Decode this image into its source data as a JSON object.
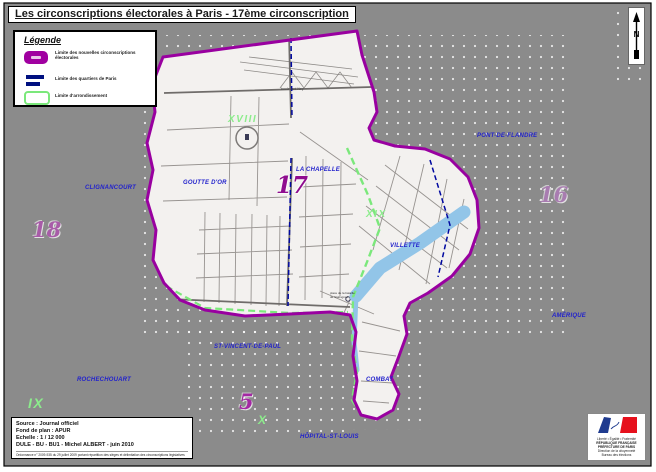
{
  "title": "Les circonscriptions électorales à Paris - 17ème circonscription",
  "legend": {
    "title": "Légende",
    "items": [
      {
        "label": "Limite des nouvelles circonscriptions électorales"
      },
      {
        "label": "Limite des quartiers de Paris"
      },
      {
        "label": "Limite d'arrondissement"
      }
    ]
  },
  "compass": {
    "label": "N"
  },
  "map": {
    "numbers": {
      "n17": "17",
      "n18": "18",
      "n16": "16",
      "n5": "5"
    },
    "arrondissements": {
      "xviii": "XVIII",
      "xix": "XIX",
      "ix": "IX",
      "x": "X"
    },
    "quartiers": {
      "clignancourt": "CLIGNANCOURT",
      "goutte_dor": "GOUTTE D'OR",
      "la_chapelle": "LA CHAPELLE",
      "pont_de_flandre": "PONT-DE-FLANDRE",
      "villette": "VILLETTE",
      "amerique": "AMÉRIQUE",
      "rochechouart": "ROCHECHOUART",
      "st_vincent_de_paul": "ST-VINCENT-DE-PAUL",
      "hopital_st_louis": "HÔPITAL-ST-LOUIS",
      "combat": "COMBAT"
    },
    "streets": {
      "bd_ney": "boulevard Ney"
    },
    "places": {
      "stalingrad": "place de la bataille de Stalingrad"
    }
  },
  "source_box": {
    "source": "Source : Journal officiel",
    "fond": "Fond de plan : APUR",
    "echelle": "Echelle : 1 / 12 000",
    "credits": "DULE - BU - BU1 - Michel ALBERT - juin 2010",
    "fine_print": "Ordonnance n° 2009-935 du 29 juillet 2009 portant répartition des sièges et délimitation des circonscriptions législatives"
  },
  "logo": {
    "motto": "Liberté • Égalité • Fraternité",
    "republic": "RÉPUBLIQUE FRANÇAISE",
    "org1": "PRÉFECTURE DE PARIS",
    "org2": "Direction de la citoyenneté",
    "org3": "Bureau des élections"
  },
  "colors": {
    "circonscription_boundary": "#9900a0",
    "quartier_boundary": "#0008a0",
    "arrondissement_boundary": "#7be87b",
    "canal": "#92c5e8",
    "background": "#8b8b8b"
  }
}
